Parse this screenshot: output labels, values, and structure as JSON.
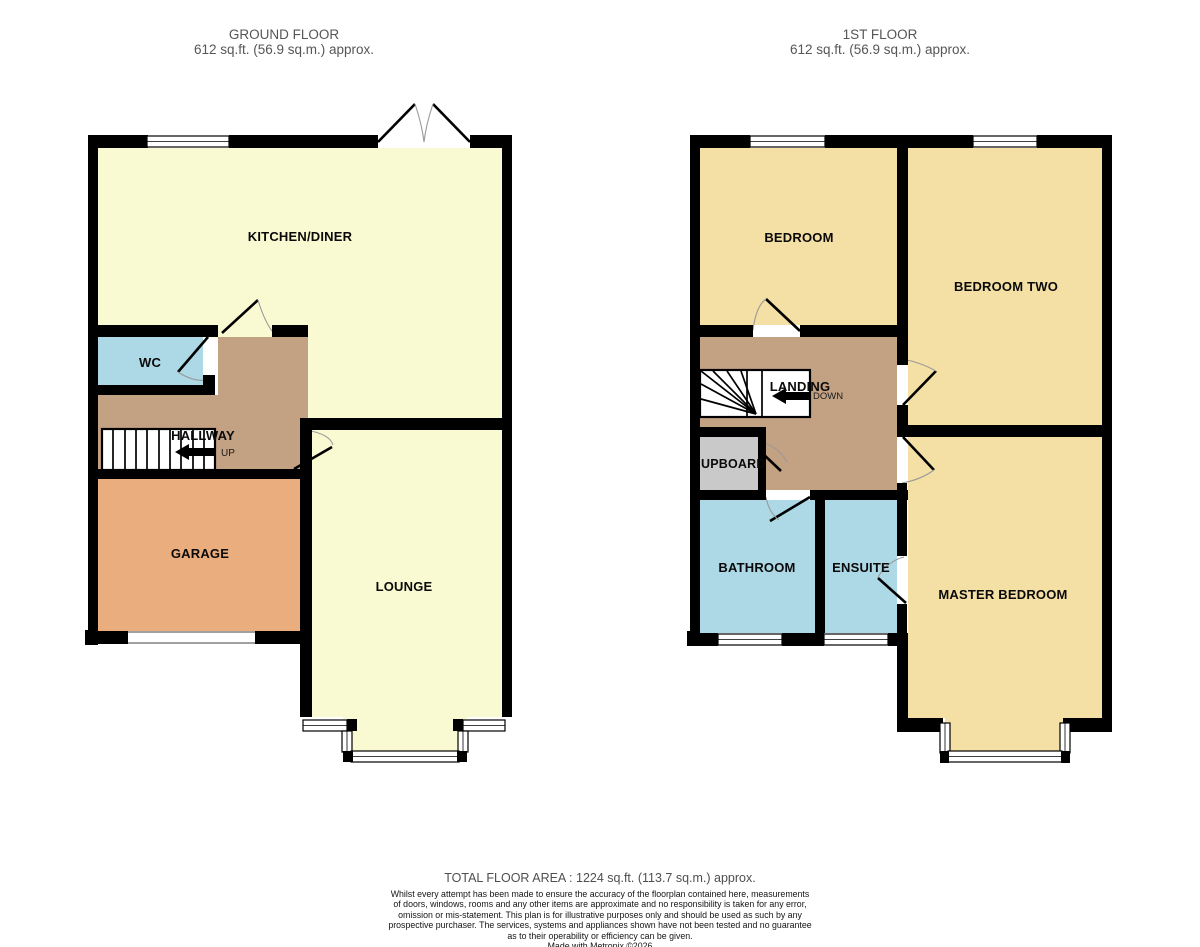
{
  "colors": {
    "wall": "#000000",
    "pale_yellow": "#FAFAD2",
    "gold_yellow": "#F4DFA4",
    "blue": "#ADD8E6",
    "tan": "#C3A183",
    "orange": "#EAAE7E",
    "gray": "#C9C9C9",
    "window_white": "#FFFFFF"
  },
  "ground_floor": {
    "title": "GROUND FLOOR",
    "area": "612 sq.ft. (56.9 sq.m.) approx.",
    "rooms": {
      "kitchen_diner": "KITCHEN/DINER",
      "wc": "WC",
      "hallway": "HALLWAY",
      "garage": "GARAGE",
      "lounge": "LOUNGE"
    },
    "stairs_direction": "UP"
  },
  "first_floor": {
    "title": "1ST FLOOR",
    "area": "612 sq.ft. (56.9 sq.m.) approx.",
    "rooms": {
      "bedroom": "BEDROOM",
      "bedroom_two": "BEDROOM TWO",
      "landing": "LANDING",
      "cupboard": "UPBOARD",
      "bathroom": "BATHROOM",
      "ensuite": "ENSUITE",
      "master_bedroom": "MASTER BEDROOM"
    },
    "stairs_direction": "DOWN"
  },
  "footer": {
    "total_area": "TOTAL FLOOR AREA : 1224 sq.ft. (113.7 sq.m.) approx.",
    "disclaimer_lines": [
      "Whilst every attempt has been made to ensure the accuracy of the floorplan contained here, measurements",
      "of doors, windows, rooms and any other items are approximate and no responsibility is taken for any error,",
      "omission or mis-statement. This plan is for illustrative purposes only and should be used as such by any",
      "prospective purchaser. The services, systems and appliances shown have not been tested and no guarantee",
      "as to their operability or efficiency can be given."
    ],
    "credit": "Made with Metropix ©2026"
  }
}
